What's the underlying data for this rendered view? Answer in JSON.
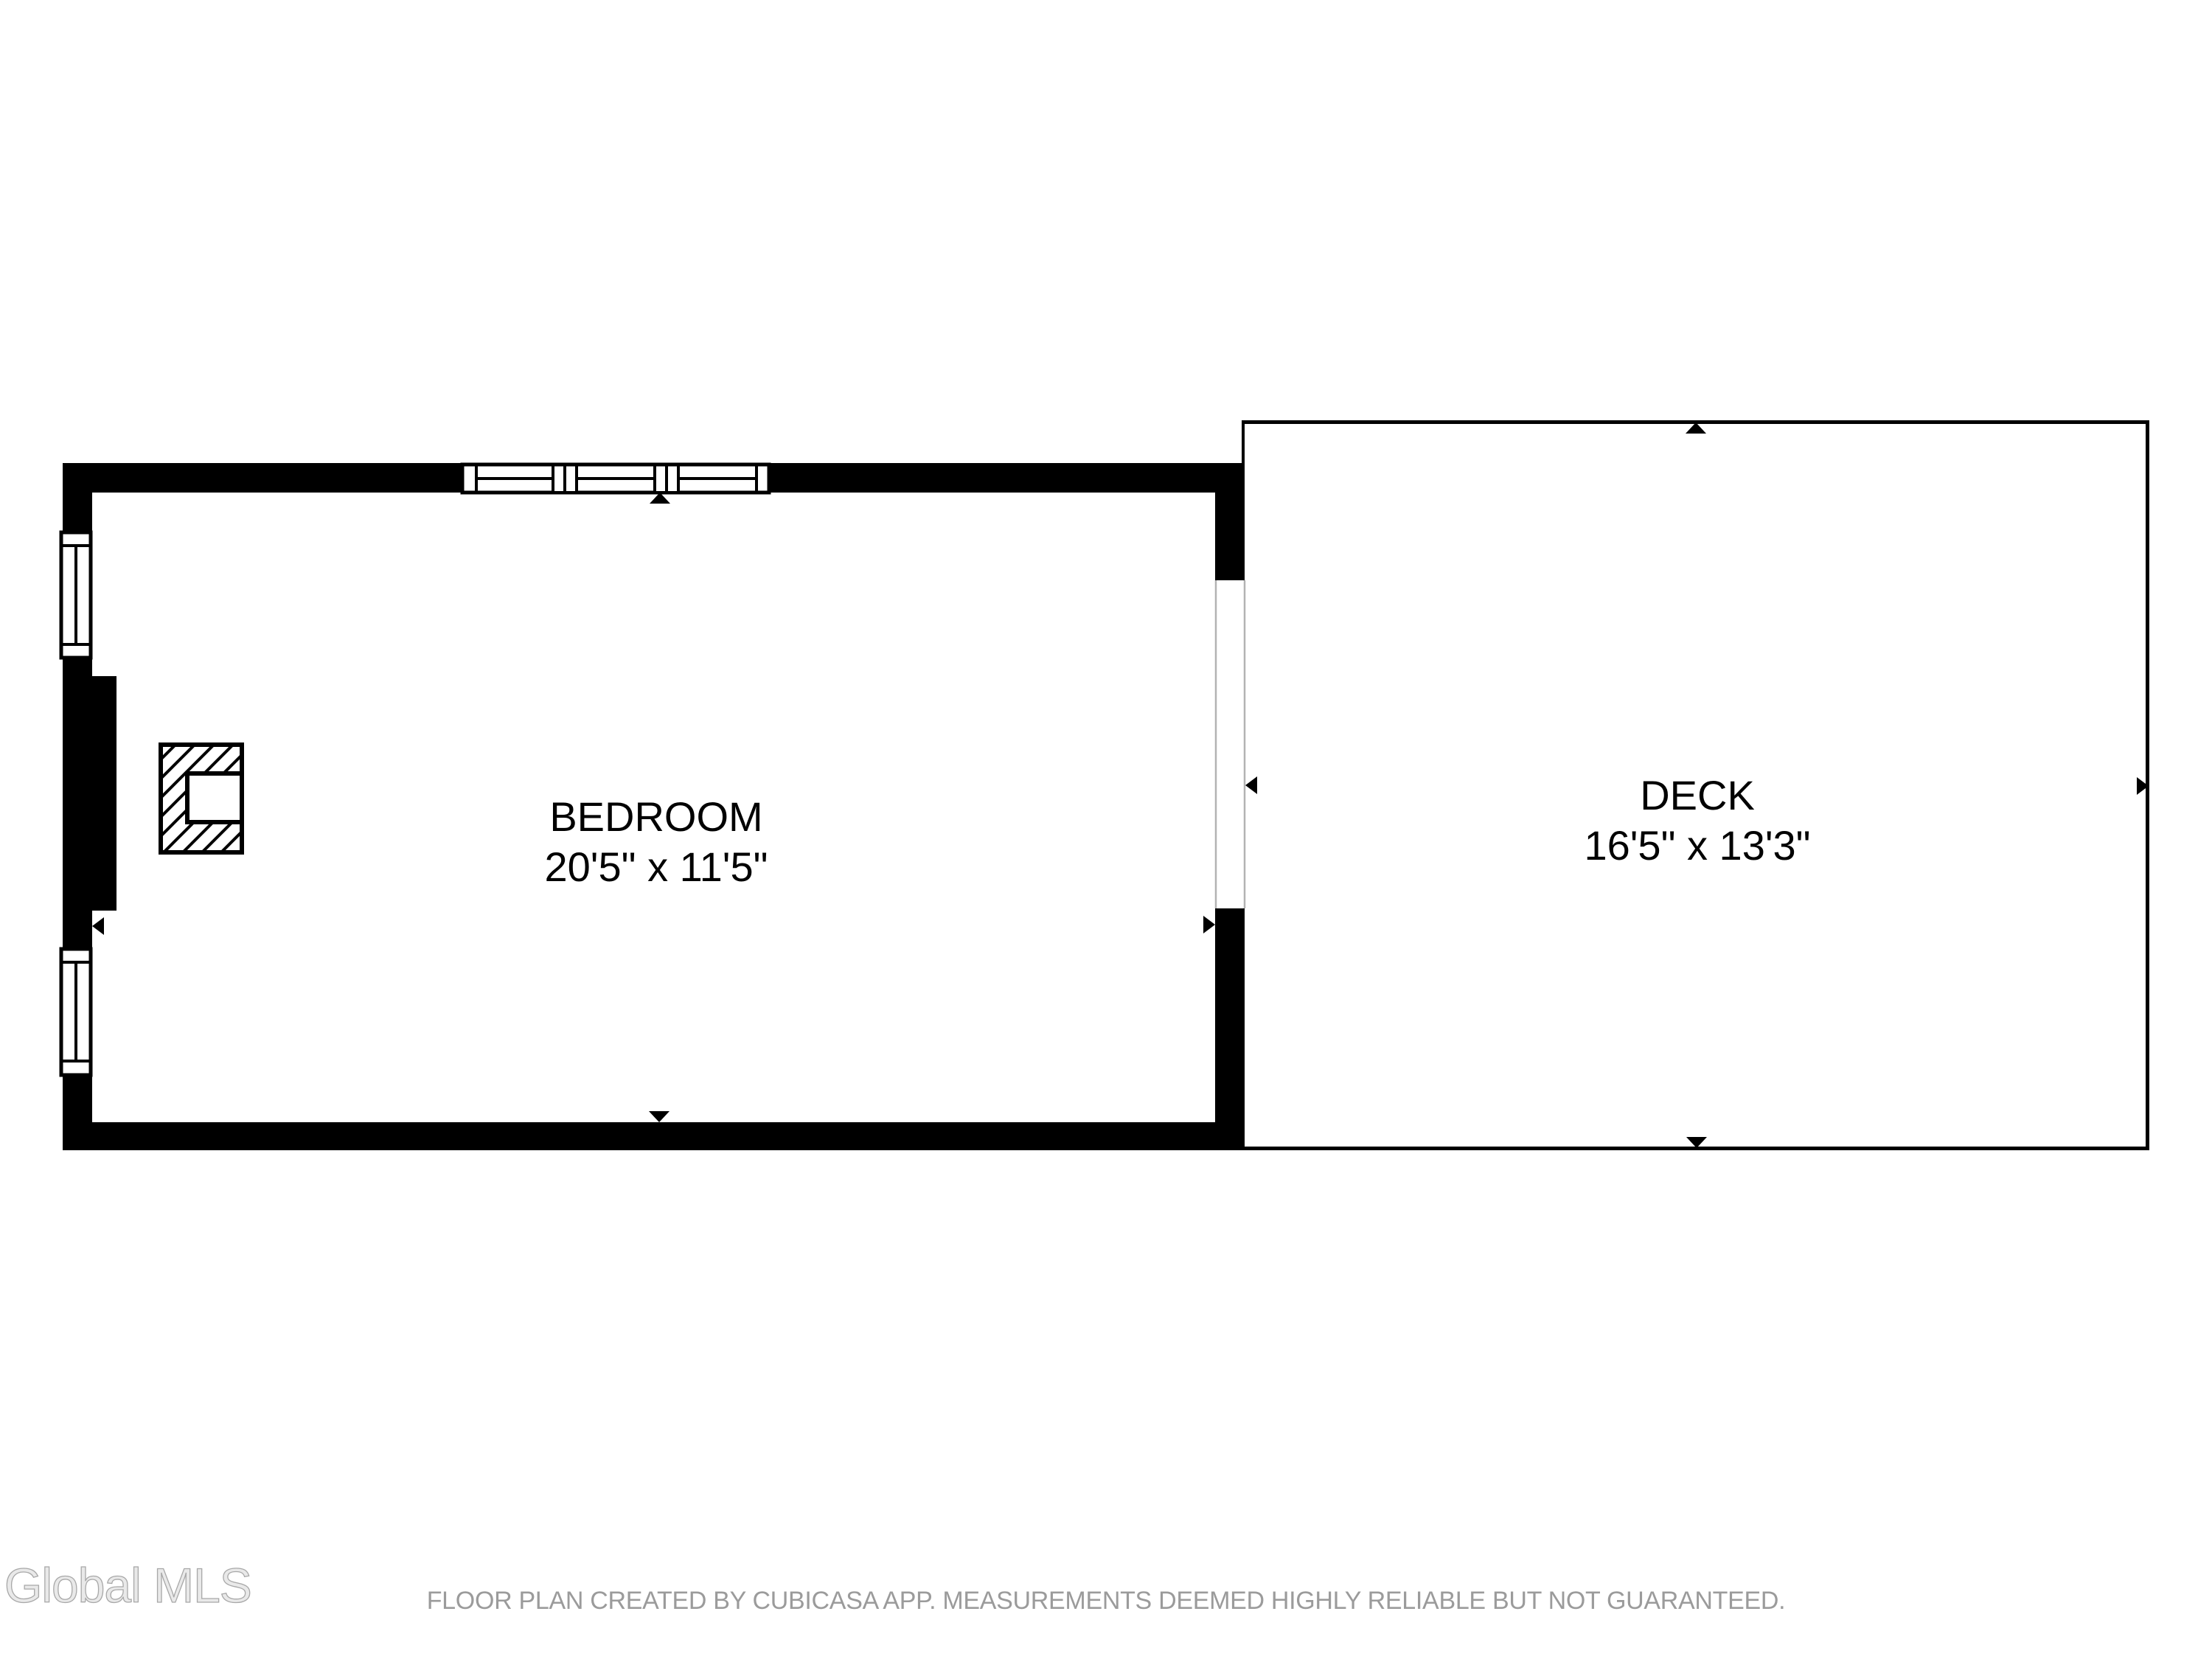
{
  "floor_plan": {
    "rooms": [
      {
        "name": "BEDROOM",
        "dimensions": "20'5\" x 11'5\""
      },
      {
        "name": "DECK",
        "dimensions": "16'5\" x 13'3\""
      }
    ],
    "symbols": {
      "window": "double-line-window",
      "chimney": "hatched-square-with-notch",
      "direction_marker": "small-black-triangle"
    },
    "colors": {
      "wall": "#000000",
      "background": "#ffffff",
      "opening_line": "#b3b3b3",
      "footer_text": "#9b9b9b",
      "watermark_stroke": "#a8a8a8"
    }
  },
  "watermark": {
    "text": "Global MLS"
  },
  "footer": {
    "disclaimer": "FLOOR PLAN CREATED BY CUBICASA APP. MEASUREMENTS DEEMED HIGHLY RELIABLE BUT NOT GUARANTEED."
  }
}
